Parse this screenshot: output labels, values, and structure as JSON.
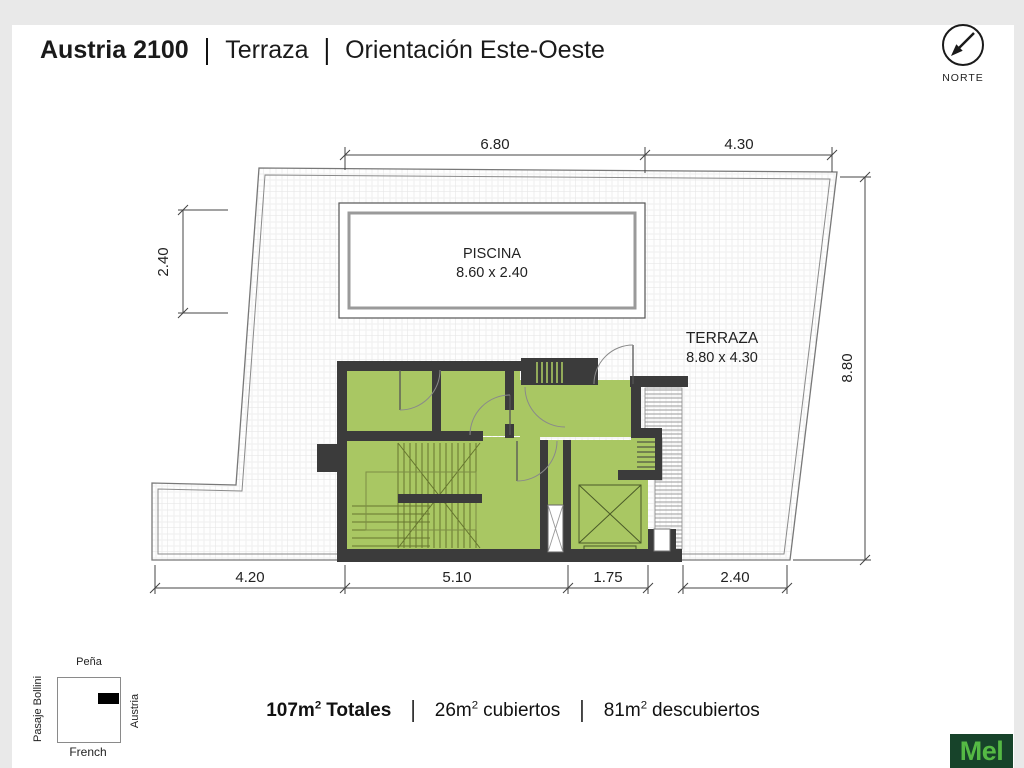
{
  "header": {
    "title": "Austria 2100",
    "separator": "|",
    "sections": [
      "Terraza",
      "Orientación Este-Oeste"
    ]
  },
  "north": {
    "label": "NORTE"
  },
  "plan": {
    "pool": {
      "name": "PISCINA",
      "size": "8.60 x 2.40"
    },
    "terrace": {
      "name": "TERRAZA",
      "size": "8.80 x 4.30"
    },
    "dimensions": {
      "top": [
        "6.80",
        "4.30"
      ],
      "left": "2.40",
      "right": "8.80",
      "bottom": [
        "4.20",
        "5.10",
        "1.75",
        "2.40"
      ]
    }
  },
  "summary": {
    "separator": "|",
    "items": [
      {
        "value": "107m",
        "sup": "2",
        "label": "Totales"
      },
      {
        "value": "26m",
        "sup": "2",
        "label": "cubiertos"
      },
      {
        "value": "81m",
        "sup": "2",
        "label": "descubiertos"
      }
    ]
  },
  "map": {
    "street_top": "Peña",
    "street_bottom": "French",
    "street_left": "Pasaje Bollini",
    "street_right": "Austria"
  },
  "logo": {
    "text": "Mel"
  },
  "colors": {
    "plan_green": "#a9c763",
    "wall_dark": "#3b3b3b",
    "logo_bg": "#17432a",
    "logo_text": "#55b944"
  }
}
